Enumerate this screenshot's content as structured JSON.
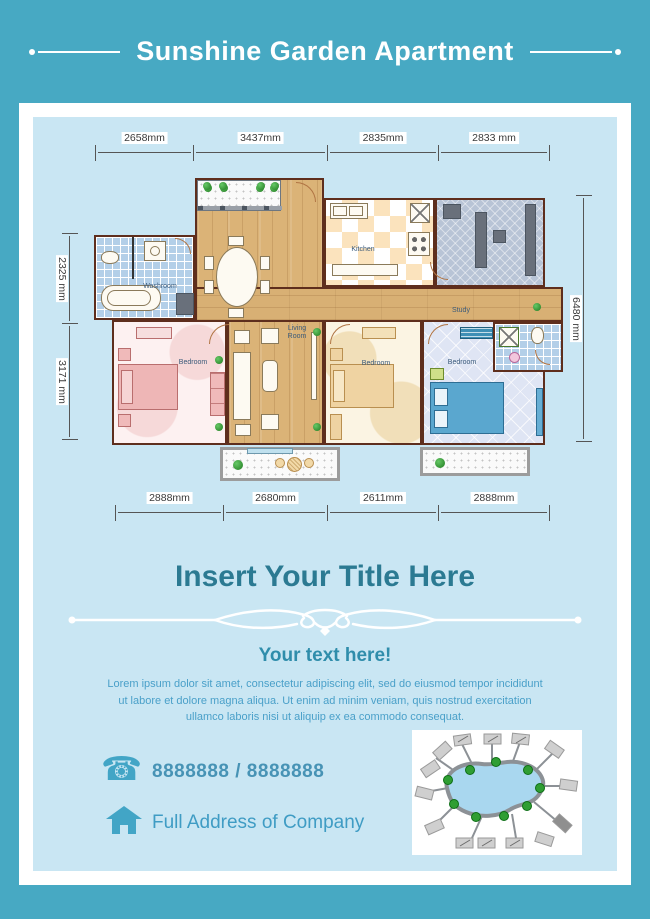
{
  "header": {
    "title": "Sunshine Garden Apartment"
  },
  "plan": {
    "dim_top": [
      "2658mm",
      "3437mm",
      "2835mm",
      "2833 mm"
    ],
    "dim_left": [
      "2325 mm",
      "3171 mm"
    ],
    "dim_right": [
      "6480 mm"
    ],
    "dim_bottom": [
      "2888mm",
      "2680mm",
      "2611mm",
      "2888mm"
    ],
    "rooms": {
      "washroom": "Washroom",
      "kitchen": "Kitchen",
      "study": "Study",
      "living_room": "Living\nRoom",
      "bedroom_left": "Bedroom",
      "bedroom_mid": "Bedroom",
      "bedroom_right": "Bedroom"
    }
  },
  "body": {
    "title": "Insert Your Title Here",
    "subtitle": "Your text here!",
    "paragraph": "Lorem ipsum dolor sit amet, consectetur adipiscing elit, sed do eiusmod tempor incididunt ut labore et dolore magna aliqua. Ut enim ad minim veniam, quis nostrud exercitation ullamco laboris nisi ut aliquip ex ea commodo consequat.",
    "phone": "8888888  /  8888888",
    "address": "Full Address of Company"
  },
  "colors": {
    "banner": "#47a9c3",
    "panel": "#c9e6f3",
    "accent": "#2b7a92",
    "body_text": "#4aa0c9"
  }
}
